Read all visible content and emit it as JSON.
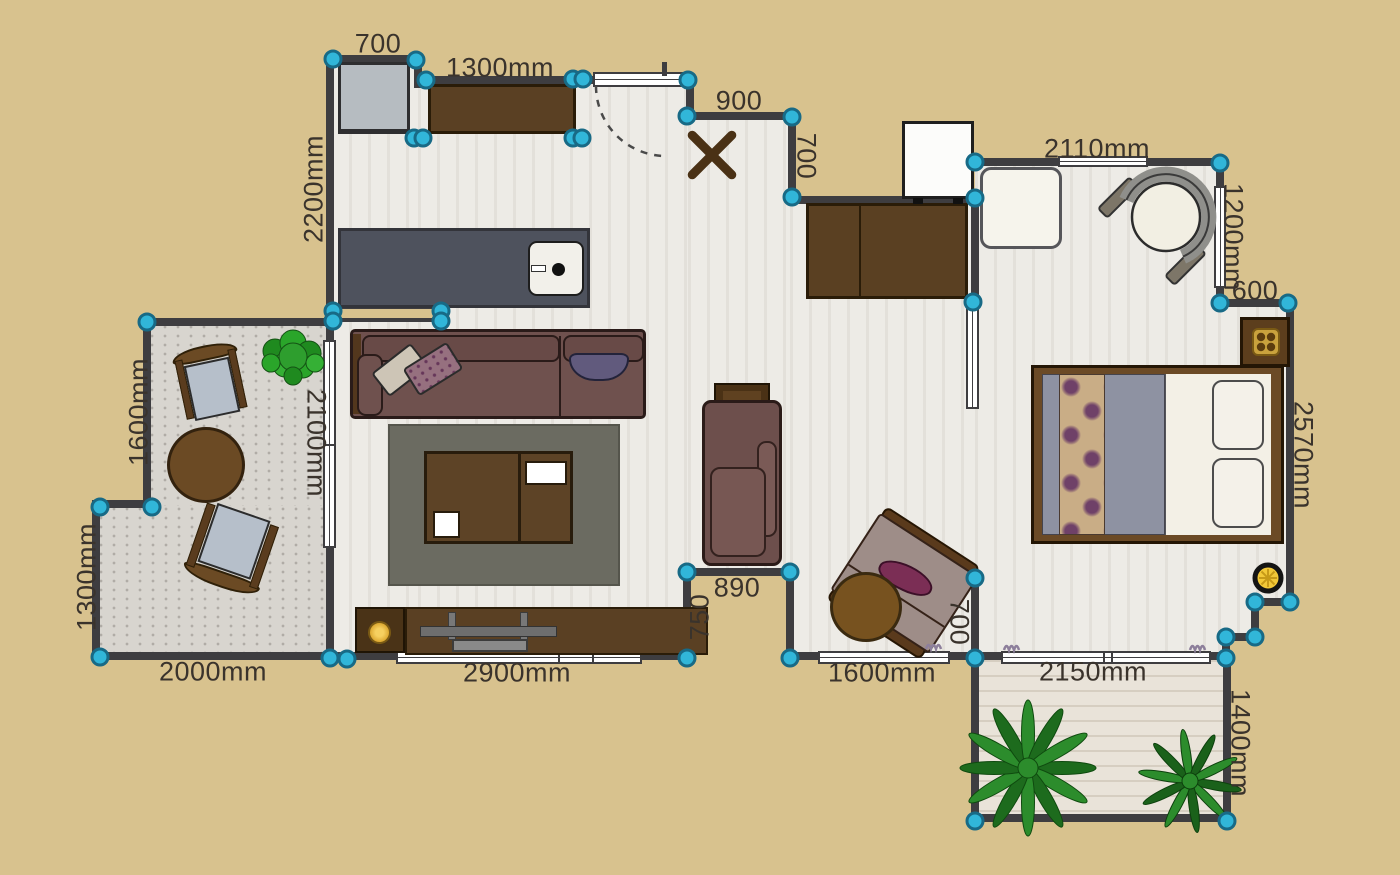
{
  "colors": {
    "background": "#d8c28e",
    "wall": "#3e3d40",
    "floor": "#edebe6",
    "patio_floor": "#d8d5cf",
    "balcony_floor": "#e9e3d9",
    "handle_fill": "#31b6d9",
    "handle_ring": "#186a86",
    "label_text": "#3a332c",
    "furniture_wood": "#5a4023",
    "sofa": "#6f514e",
    "rug": "#6b6b61",
    "counter": "#4e525d",
    "bed_blanket": "#8e92a2",
    "lamp_yellow": "#f2c838",
    "gold_accent": "#c9a23d",
    "plant_green": "#2c8c2c",
    "window_mark_purple": "#8d7f9b"
  },
  "labels": [
    {
      "text": "700"
    },
    {
      "text": "1300mm"
    },
    {
      "text": "2200mm"
    },
    {
      "text": "900"
    },
    {
      "text": "700"
    },
    {
      "text": "2110mm"
    },
    {
      "text": "1200mm"
    },
    {
      "text": "600"
    },
    {
      "text": "2570mm"
    },
    {
      "text": "2100mm"
    },
    {
      "text": "1600mm"
    },
    {
      "text": "1300mm"
    },
    {
      "text": "2000mm"
    },
    {
      "text": "2900mm"
    },
    {
      "text": "890"
    },
    {
      "text": "750"
    },
    {
      "text": "1600mm"
    },
    {
      "text": "700"
    },
    {
      "text": "2150mm"
    },
    {
      "text": "1400mm"
    }
  ]
}
